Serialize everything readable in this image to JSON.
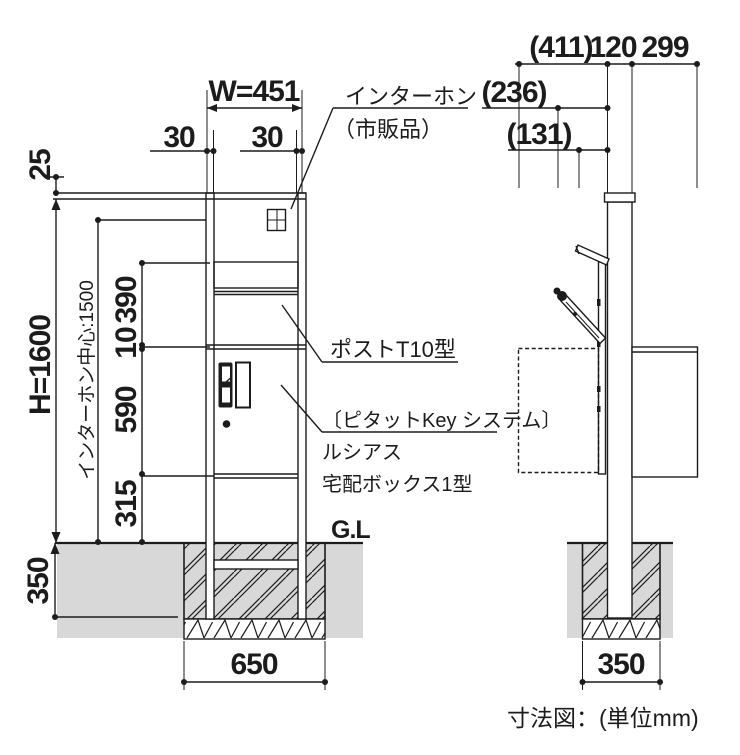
{
  "caption": "寸法図：(単位mm)",
  "front_view": {
    "dimensions": {
      "width": "W=451",
      "left_margin": "30",
      "right_margin": "30",
      "cap_height": "25",
      "total_height": "H=1600",
      "intercom_center": "インターホン中心:1500",
      "post_section": "390",
      "gap": "10",
      "box_section": "590",
      "lower_section": "315",
      "embed_depth": "350",
      "footing_width": "650"
    },
    "labels": {
      "intercom": "インターホン",
      "intercom_note": "（市販品）",
      "post_model": "ポストT10型",
      "key_system": "〔ピタットKey システム〕",
      "series_name": "ルシアス",
      "product_name": "宅配ボックス1型",
      "ground_level": "G.L"
    }
  },
  "side_view": {
    "dimensions": {
      "overall_depth": "(411)",
      "pillar_depth": "120",
      "rear_offset": "299",
      "box_depth": "(236)",
      "door_depth": "(131)",
      "footing_width": "350"
    }
  },
  "colors": {
    "line": "#1c1c1c",
    "ground_fill": "#d8d8d8",
    "background": "#ffffff"
  }
}
